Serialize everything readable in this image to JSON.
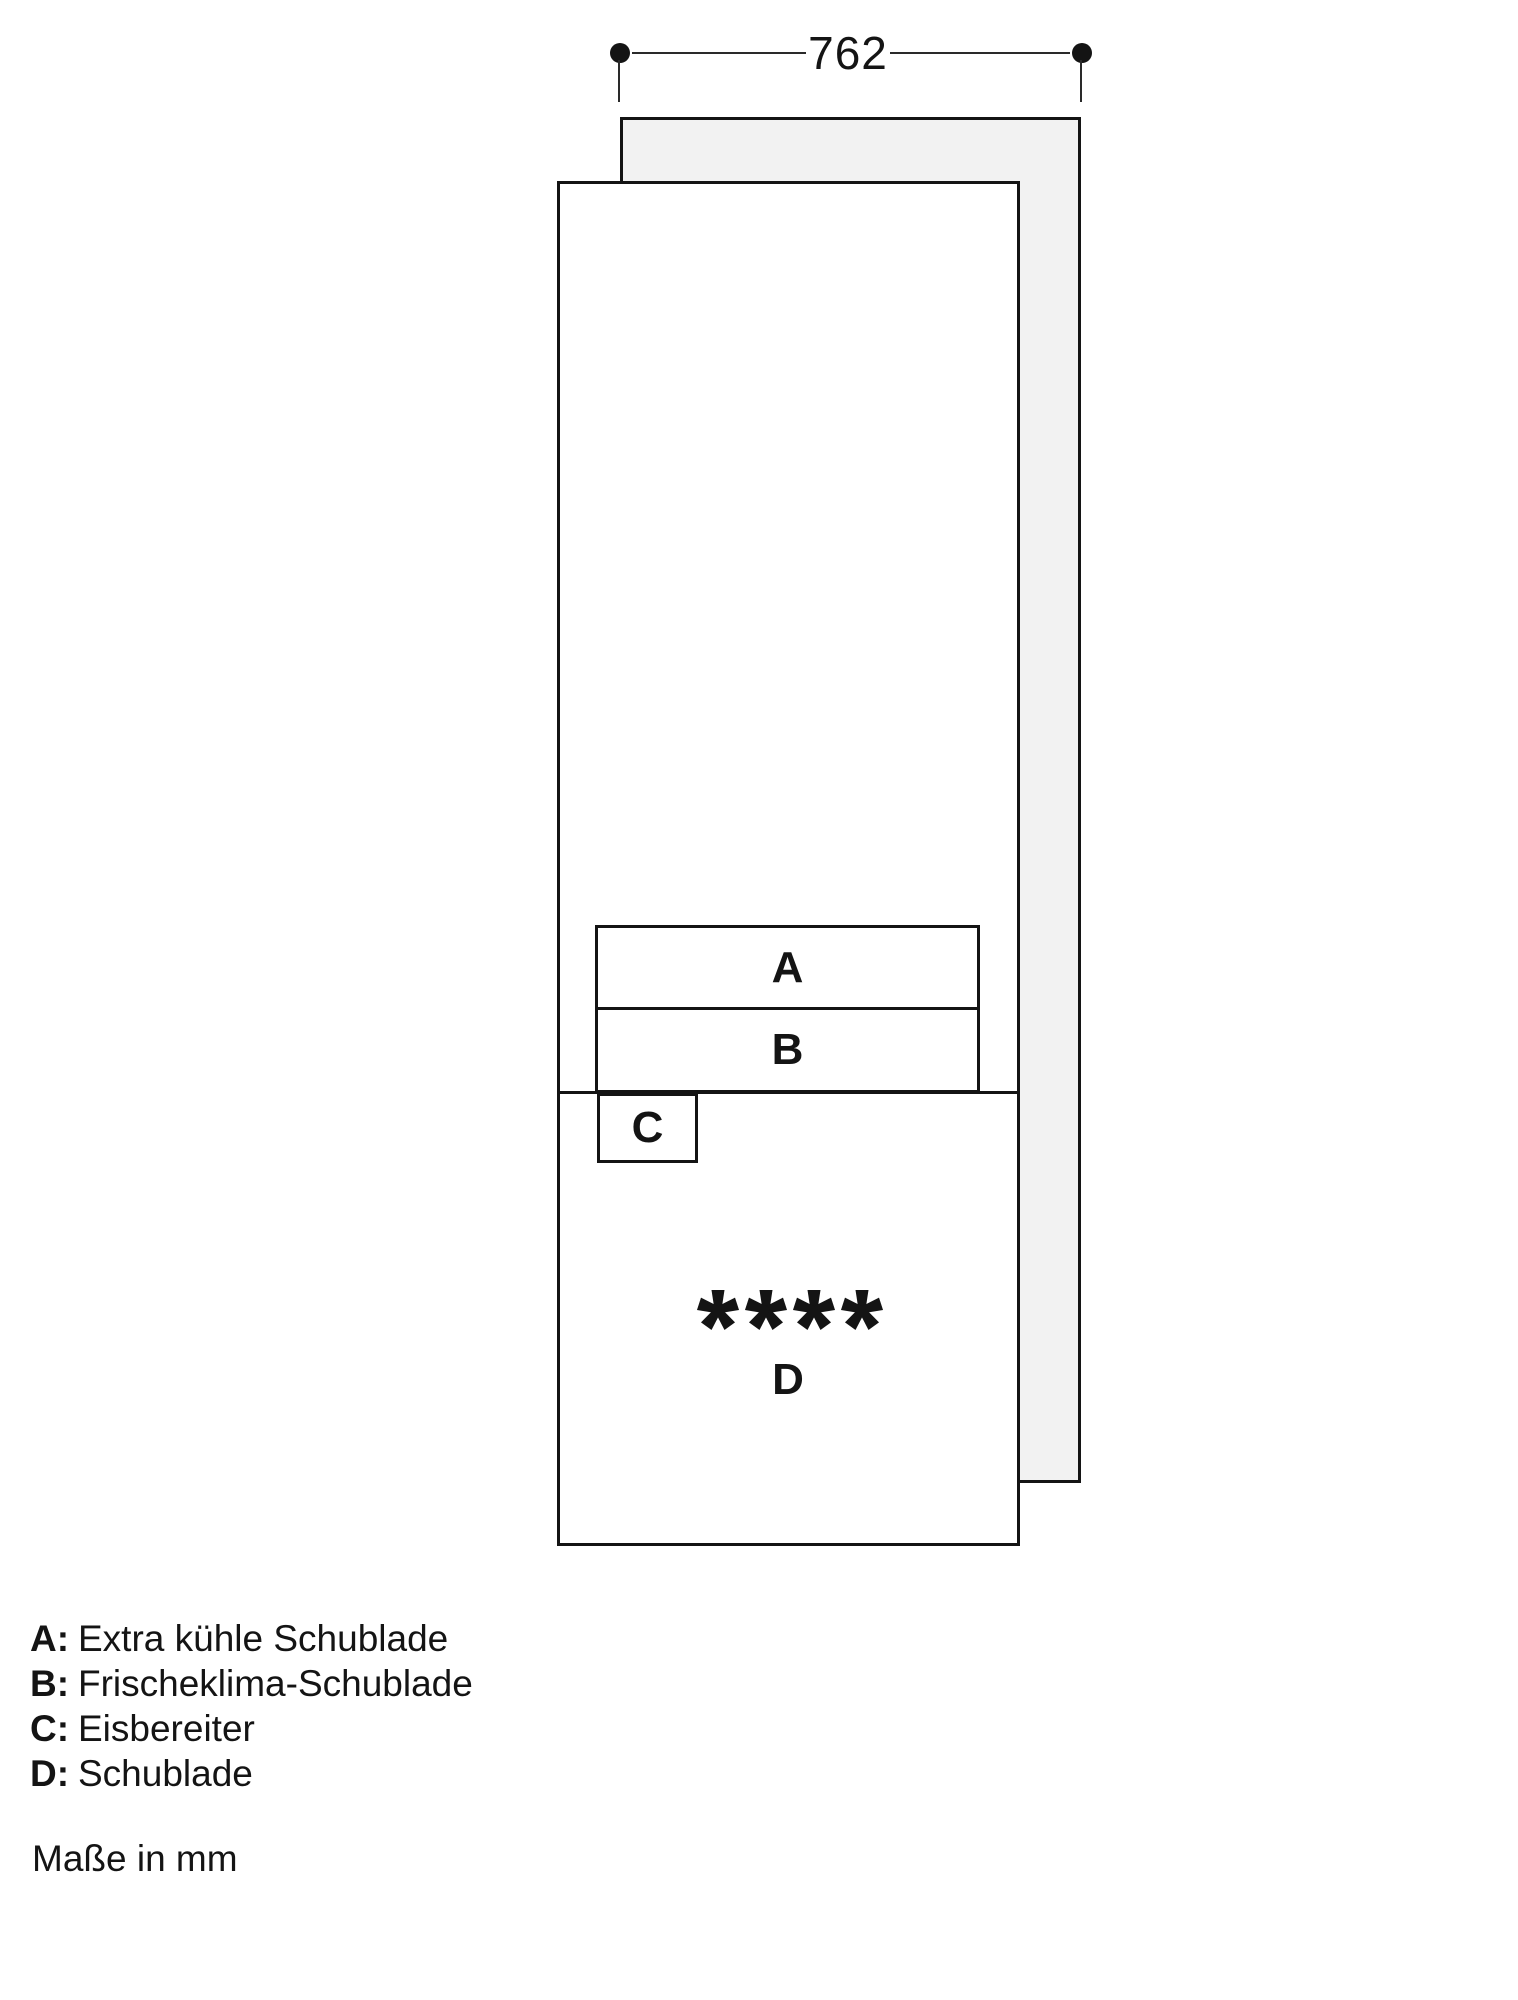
{
  "diagram": {
    "dimension_width_mm": "762",
    "compartments": {
      "a": "A",
      "b": "B",
      "c": "C",
      "d": "D"
    }
  },
  "legend": {
    "items": [
      {
        "key": "A:",
        "label": "Extra kühle Schublade"
      },
      {
        "key": "B:",
        "label": "Frischeklima-Schublade"
      },
      {
        "key": "C:",
        "label": "Eisbereiter"
      },
      {
        "key": "D:",
        "label": "Schublade"
      }
    ]
  },
  "note": "Maße in mm",
  "icons": {
    "freezer_rating": "four-star-freezer-rating-icon"
  },
  "colors": {
    "line": "#141414",
    "panel_fill": "#f2f2f2",
    "background": "#ffffff"
  }
}
